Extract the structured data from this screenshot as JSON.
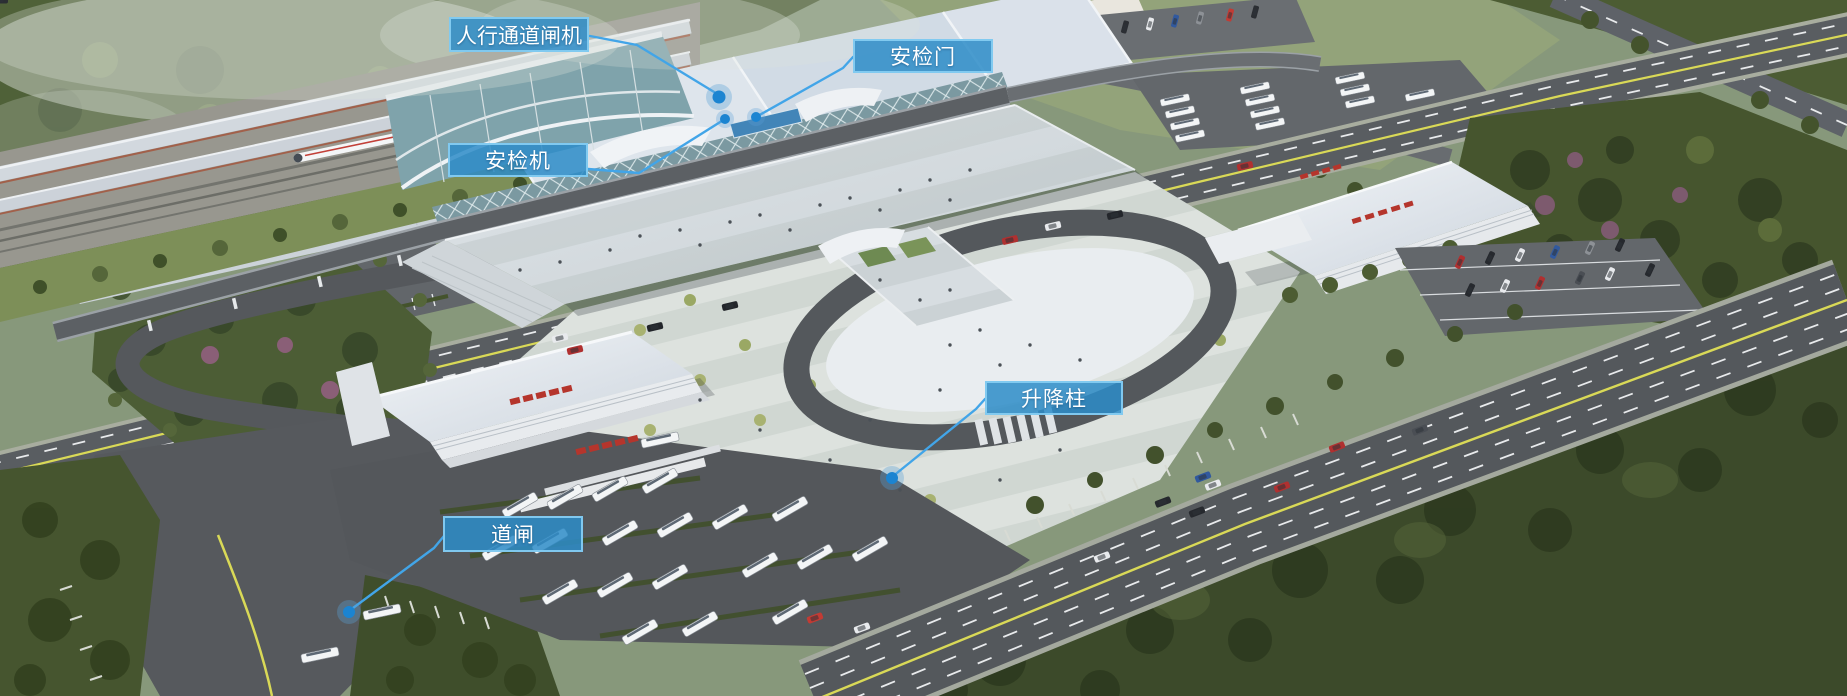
{
  "callouts": [
    {
      "id": "pedestrian-channel-gate",
      "label": "人行通道闸机"
    },
    {
      "id": "security-door",
      "label": "安检门"
    },
    {
      "id": "security-scanner",
      "label": "安检机"
    },
    {
      "id": "lifting-bollard",
      "label": "升降柱"
    },
    {
      "id": "barrier-gate",
      "label": "道闸"
    }
  ],
  "colors": {
    "label_background": "#2d8cc8",
    "label_border": "#87cef3",
    "leader_line": "#42a5e8",
    "marker_dot": "#1b84d1"
  }
}
